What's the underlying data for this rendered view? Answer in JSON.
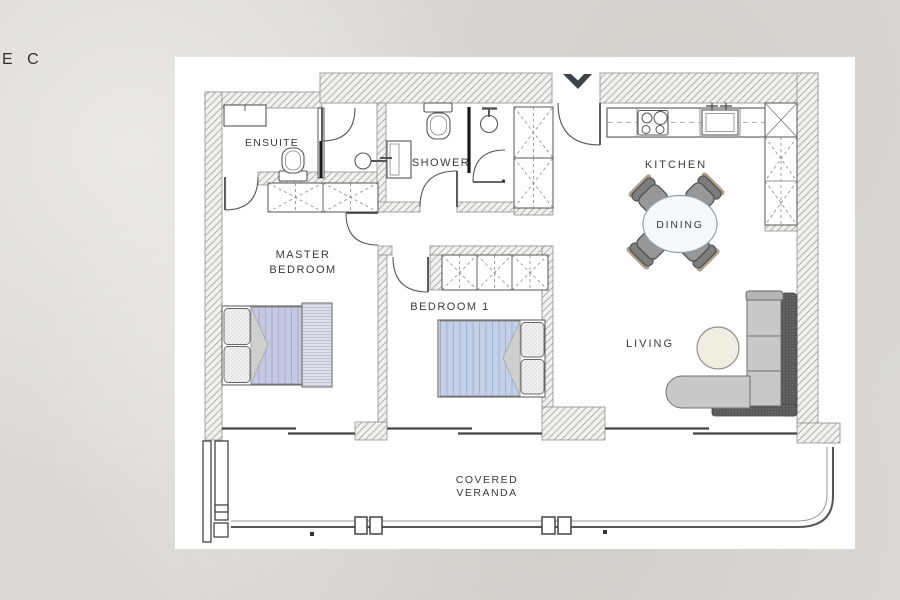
{
  "page": {
    "corner_label": "E C"
  },
  "labels": {
    "ensuite": "ENSUITE",
    "shower": "SHOWER",
    "master_line1": "MASTER",
    "master_line2": "BEDROOM",
    "bedroom1": "BEDROOM 1",
    "kitchen": "KITCHEN",
    "dining": "DINING",
    "living": "LIVING",
    "veranda_line1": "COVERED",
    "veranda_line2": "VERANDA"
  },
  "colors": {
    "wall_hatch": "#ababab",
    "label_text": "#3a3a3a",
    "master_duvet": "#c6c8e2",
    "bedroom1_duvet": "#c3d0e8",
    "chair": "#979797",
    "chair_back": "#7e7e7e",
    "chair_trim": "#ab9f87",
    "dining_table": "#f6f9fb",
    "sofa_seat": "#c8c8c8",
    "sofa_back": "#575757",
    "coffee_table": "#f0ede1",
    "entrance_arrow": "#3d4246"
  }
}
